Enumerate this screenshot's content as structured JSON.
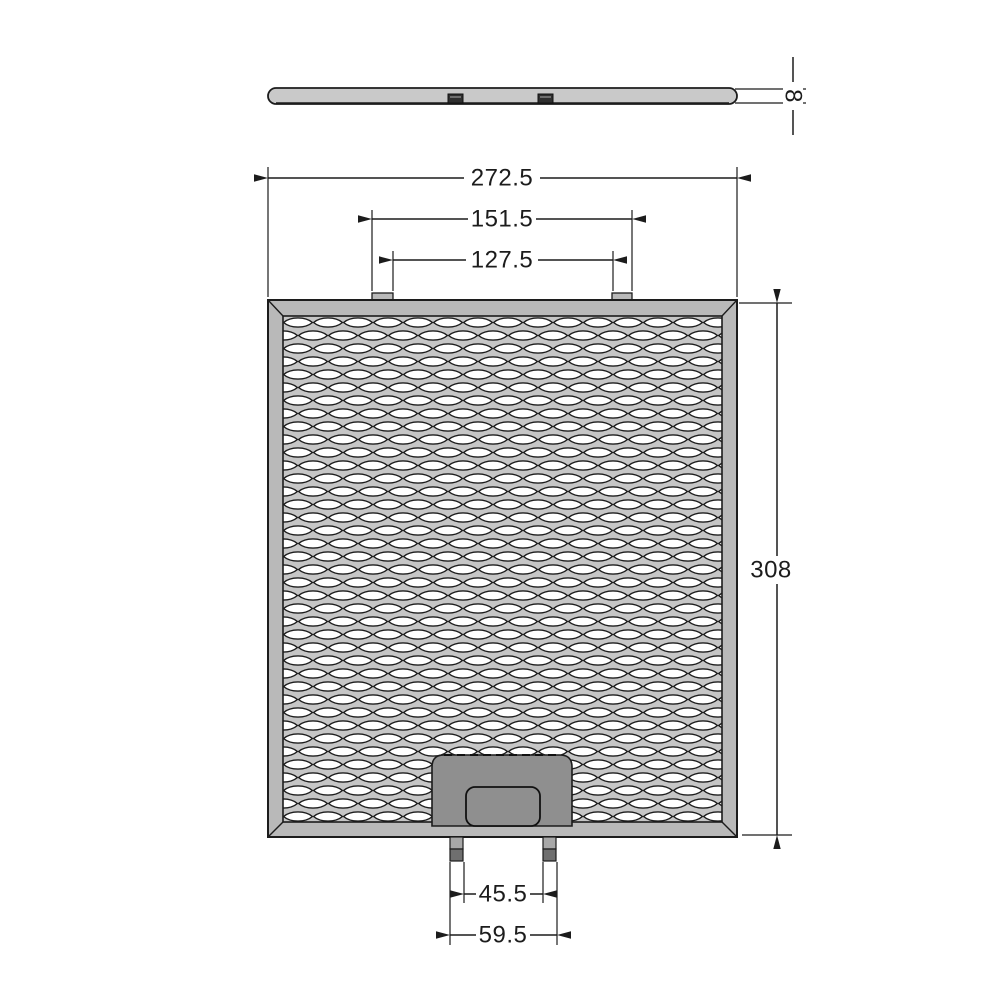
{
  "drawing": {
    "kind": "grease-filter-technical-drawing",
    "dimensions": {
      "thickness": "8",
      "overall_width": "272.5",
      "tab_outer_spacing": "151.5",
      "tab_inner_spacing": "127.5",
      "overall_height": "308",
      "pin_inner_spacing": "45.5",
      "pin_outer_spacing": "59.5"
    },
    "colors": {
      "line": "#1c1c1c",
      "frame": "#b9b9b9",
      "bar": "#c9c9c9",
      "mesh_bg": "#c6c6c6",
      "mesh_hole": "#ffffff",
      "mesh_stroke": "#1d1d1d",
      "latch": "#8f8f8f",
      "pin_light": "#a8a8a8",
      "pin_dark": "#6f6f6f",
      "clip": "#2f2f2f"
    }
  }
}
